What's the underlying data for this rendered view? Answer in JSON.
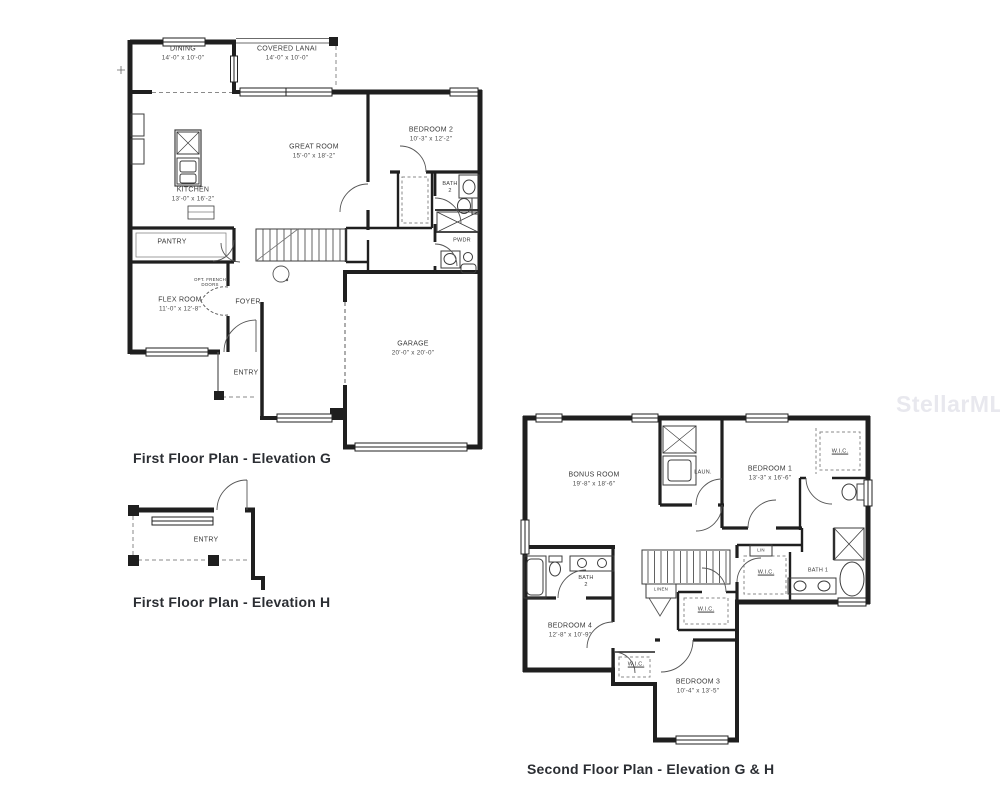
{
  "watermark": {
    "text": "StellarMLS",
    "color": "#e8e8ee"
  },
  "plans": {
    "first_floor_g": {
      "caption": "First Floor Plan - Elevation G",
      "rooms": {
        "dining": {
          "line1": "DINING",
          "line2": "14'-0\" x 10'-0\""
        },
        "covered_lanai": {
          "line1": "COVERED LANAI",
          "line2": "14'-0\" x 10'-0\""
        },
        "great_room": {
          "line1": "GREAT ROOM",
          "line2": "15'-0\" x 18'-2\""
        },
        "bedroom_2": {
          "line1": "BEDROOM 2",
          "line2": "10'-3\" x 12'-2\""
        },
        "kitchen": {
          "line1": "KITCHEN",
          "line2": "13'-0\" x 16'-2\""
        },
        "bath_2": {
          "line1": "BATH",
          "line2": "2"
        },
        "powder": {
          "line1": "PWDR"
        },
        "pantry": {
          "line1": "PANTRY"
        },
        "flex_room": {
          "line1": "FLEX ROOM",
          "line2": "11'-0\" x 12'-8\""
        },
        "opt_french_doors": {
          "line1": "OPT. FRENCH",
          "line2": "DOORS"
        },
        "foyer": {
          "line1": "FOYER"
        },
        "garage": {
          "line1": "GARAGE",
          "line2": "20'-0\" x 20'-0\""
        },
        "entry": {
          "line1": "ENTRY"
        }
      }
    },
    "first_floor_h": {
      "caption": "First Floor Plan - Elevation H",
      "rooms": {
        "entry": {
          "line1": "ENTRY"
        }
      }
    },
    "second_floor": {
      "caption": "Second Floor Plan - Elevation G & H",
      "rooms": {
        "bonus_room": {
          "line1": "BONUS ROOM",
          "line2": "19'-8\" x 18'-6\""
        },
        "laundry": {
          "line1": "LAUN."
        },
        "bedroom_1": {
          "line1": "BEDROOM 1",
          "line2": "13'-3\" x 16'-6\""
        },
        "wic_bedroom_1": {
          "line1": "W.I.C."
        },
        "bath_1": {
          "line1": "BATH 1"
        },
        "wic_hall": {
          "line1": "W.I.C."
        },
        "linen_cabinet": {
          "line1": "LIN"
        },
        "bath_2": {
          "line1": "BATH",
          "line2": "2"
        },
        "linen": {
          "line1": "LINEN"
        },
        "wic_center": {
          "line1": "W.I.C."
        },
        "bedroom_4": {
          "line1": "BEDROOM 4",
          "line2": "12'-8\" x 10'-9\""
        },
        "wic_bedroom_3": {
          "line1": "W.I.C."
        },
        "bedroom_3": {
          "line1": "BEDROOM 3",
          "line2": "10'-4\" x 13'-5\""
        }
      }
    }
  }
}
